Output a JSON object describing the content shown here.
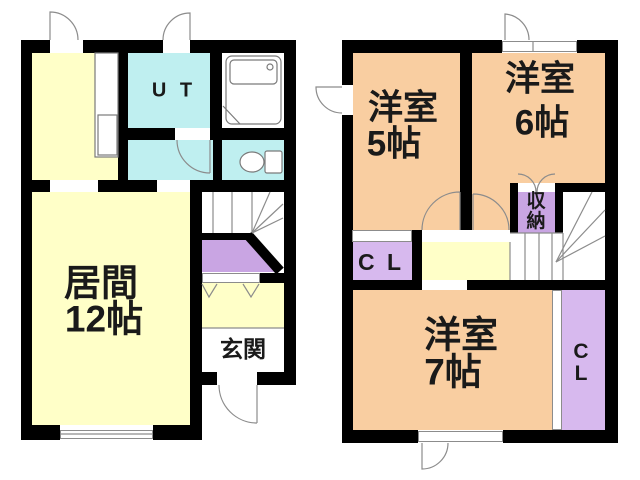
{
  "colors": {
    "bg": "#FFFFFF",
    "wall": "#000000",
    "floor_yellow": "#FFFFC8",
    "wet_cyan": "#BFEFF0",
    "bedroom_peach": "#F9CEA1",
    "closet_purple": "#D7B9EE",
    "storage_purple": "#C9A5E3",
    "line_gray": "#8C8C8C",
    "text": "#1A1A1A"
  },
  "floor1": {
    "living": {
      "name": "居間",
      "size": "12帖"
    },
    "utility": {
      "label": "U T"
    },
    "entrance": {
      "label": "玄関"
    }
  },
  "floor2": {
    "room5": {
      "name": "洋室",
      "size": "5帖"
    },
    "room6": {
      "name": "洋室",
      "size": "6帖"
    },
    "room7": {
      "name": "洋室",
      "size": "7帖"
    },
    "closet_a": {
      "label": "C L"
    },
    "closet_b": {
      "char1": "C",
      "char2": "L"
    },
    "storage": {
      "char1": "収",
      "char2": "納"
    }
  }
}
